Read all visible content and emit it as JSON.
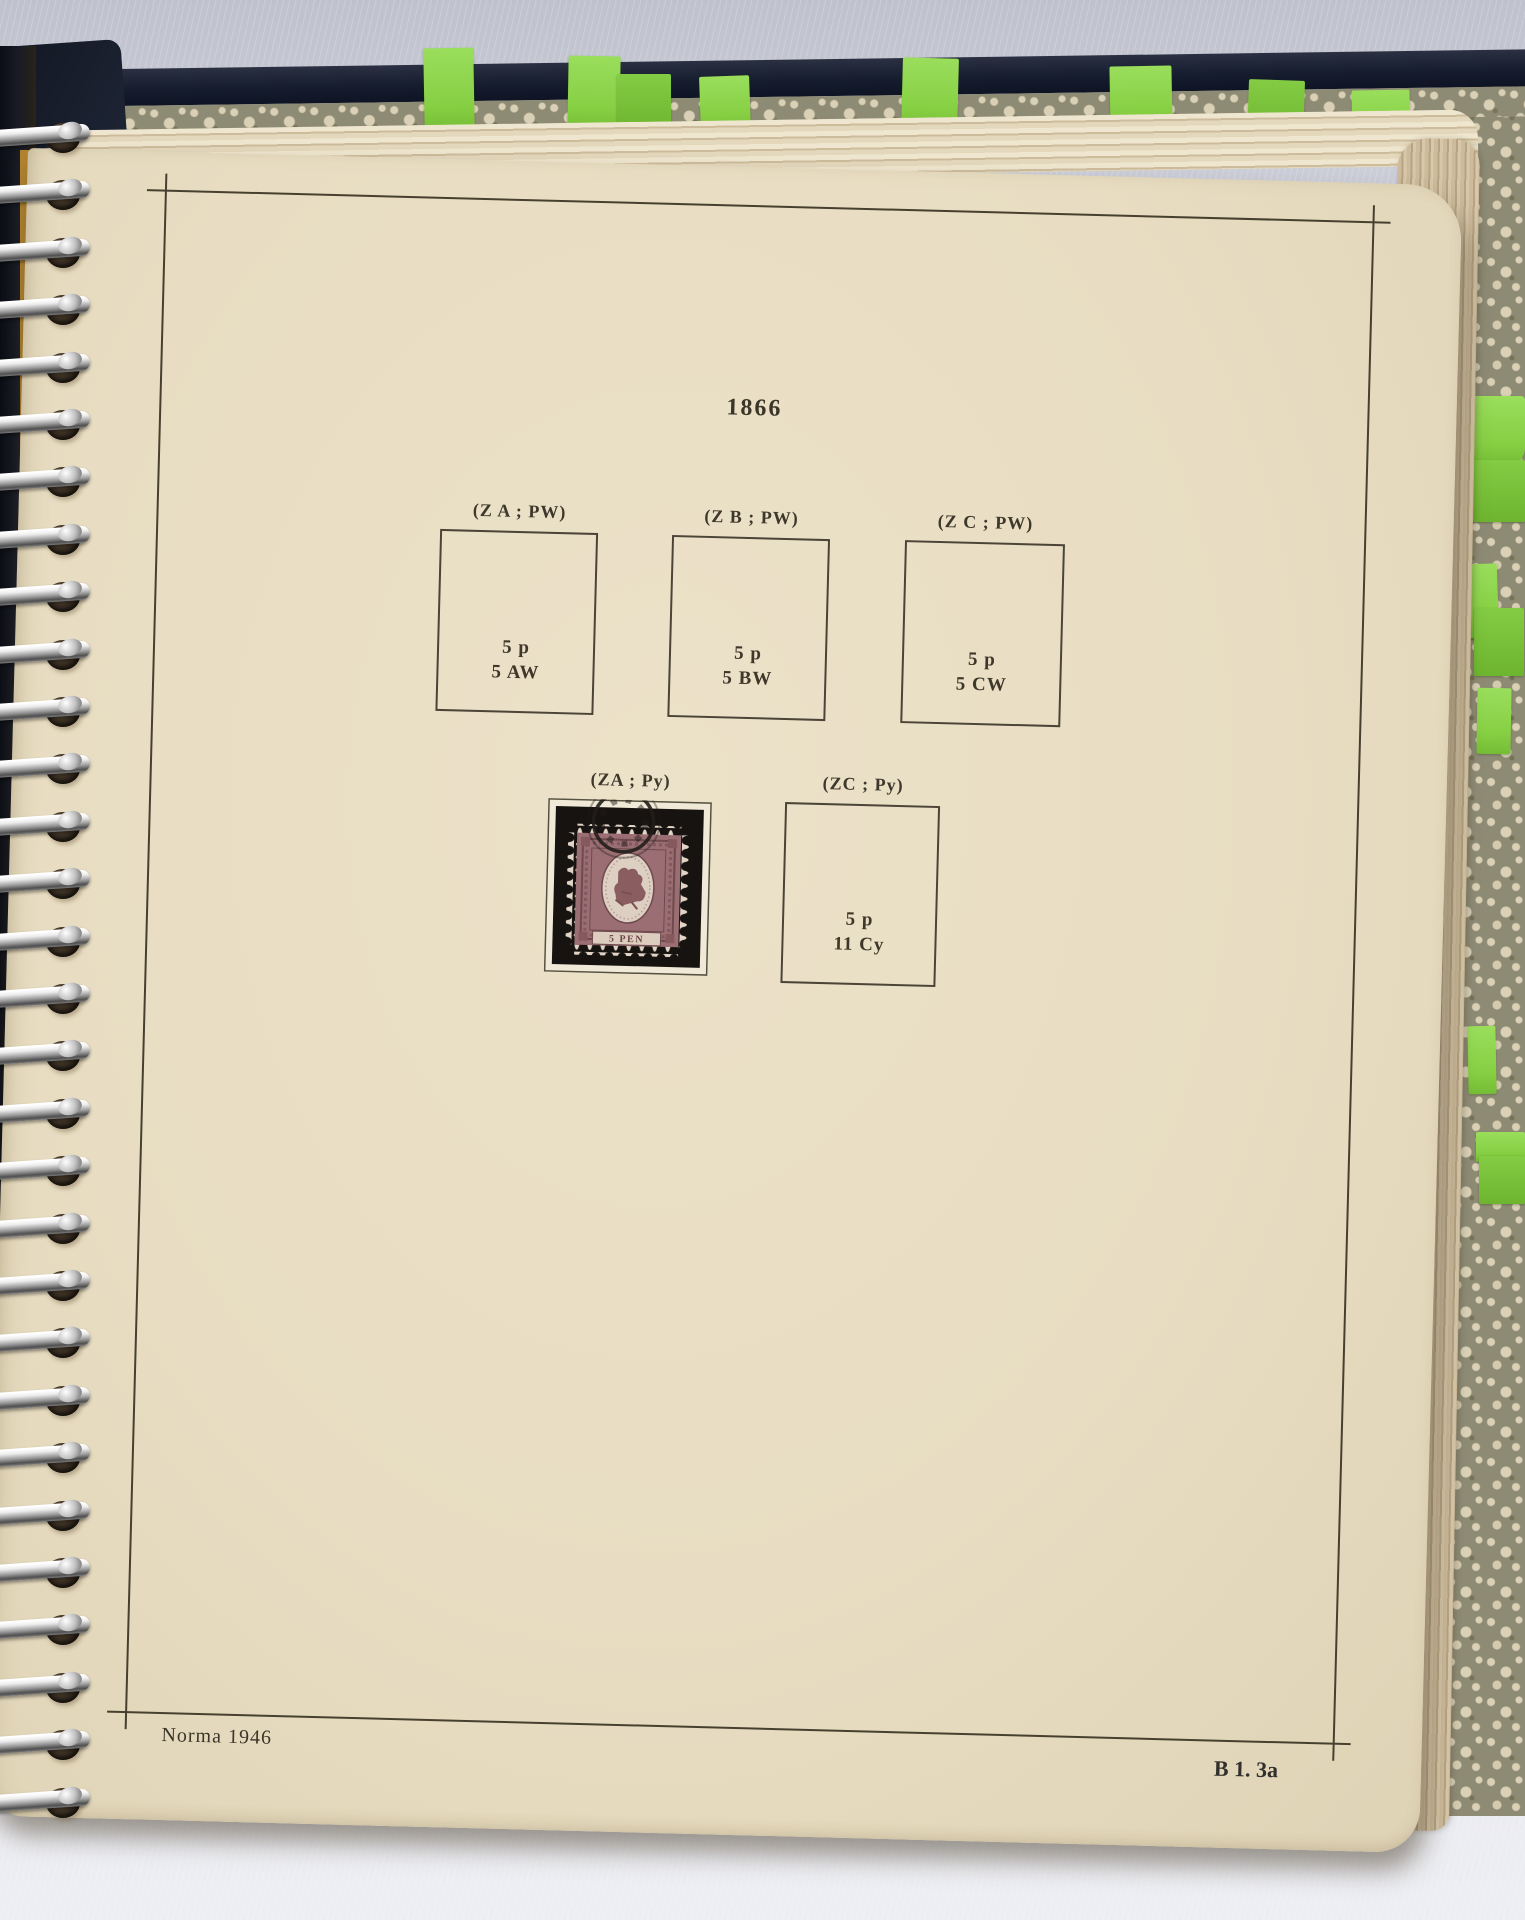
{
  "album_page": {
    "year_heading": "1866",
    "rows": [
      {
        "slots": [
          {
            "label": "(Z A ; PW)",
            "line1": "5 p",
            "line2": "5 AW"
          },
          {
            "label": "(Z B ; PW)",
            "line1": "5 p",
            "line2": "5 BW"
          },
          {
            "label": "(Z C ; PW)",
            "line1": "5 p",
            "line2": "5 CW"
          }
        ]
      },
      {
        "slots": [
          {
            "label": "(ZA ; Py)"
          },
          {
            "label": "(ZC ; Py)",
            "line1": "5 p",
            "line2": "11 Cy"
          }
        ]
      }
    ],
    "footer_left": "Norma 1946",
    "footer_right": "B 1. 3a"
  },
  "stamp": {
    "denomination_text": "5 PEN"
  },
  "binding": {
    "ring_count": 30
  },
  "tabs": {
    "top_count": 8,
    "right_count": 8,
    "color": "#8ed24c"
  },
  "colors": {
    "page_cream": "#e8ddc2",
    "ink": "#47402f",
    "cover_navy": "#161d2e",
    "pattern_base": "#8e8b75",
    "pattern_motif": "#d9d0b6",
    "stamp_body": "#9a6e72",
    "mount_black": "#161310",
    "tab_green": "#8ed24c"
  }
}
